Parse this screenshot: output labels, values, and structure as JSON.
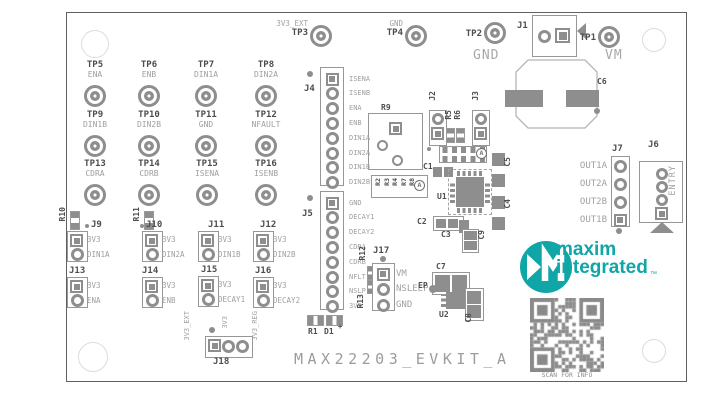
{
  "board": {
    "title": "MAX22203_EVKIT_A",
    "scan_label": "SCAN FOR INFO"
  },
  "logo": {
    "line1": "maxim",
    "line2": "integrated",
    "tm": "™"
  },
  "marker": "A",
  "colors": {
    "teal": "#10a5a6",
    "silk_dark": "#4d4d4d",
    "silk_light": "#a0a0a0",
    "pad": "#8e8e8e",
    "qr": "#8a8a8a"
  },
  "test_points": [
    {
      "ref": "TP5",
      "signal": "ENA",
      "x": 95,
      "y": 96
    },
    {
      "ref": "TP6",
      "signal": "ENB",
      "x": 149,
      "y": 96
    },
    {
      "ref": "TP7",
      "signal": "DIN1A",
      "x": 206,
      "y": 96
    },
    {
      "ref": "TP8",
      "signal": "DIN2A",
      "x": 266,
      "y": 96
    },
    {
      "ref": "TP9",
      "signal": "DIN1B",
      "x": 95,
      "y": 146
    },
    {
      "ref": "TP10",
      "signal": "DIN2B",
      "x": 149,
      "y": 146
    },
    {
      "ref": "TP11",
      "signal": "GND",
      "x": 206,
      "y": 146
    },
    {
      "ref": "TP12",
      "signal": "NFAULT",
      "x": 266,
      "y": 146
    },
    {
      "ref": "TP13",
      "signal": "CDRA",
      "x": 95,
      "y": 195
    },
    {
      "ref": "TP14",
      "signal": "CDRB",
      "x": 149,
      "y": 195
    },
    {
      "ref": "TP15",
      "signal": "ISENA",
      "x": 207,
      "y": 195
    },
    {
      "ref": "TP16",
      "signal": "ISENB",
      "x": 266,
      "y": 195
    }
  ],
  "top_test_points": [
    {
      "ref": "TP3",
      "signal": "3V3_EXT",
      "x": 321,
      "y": 36,
      "big": false
    },
    {
      "ref": "TP4",
      "signal": "GND",
      "x": 416,
      "y": 36,
      "big": false
    },
    {
      "ref": "TP2",
      "signal": "GND",
      "x": 495,
      "y": 33,
      "big": true
    },
    {
      "ref": "TP1",
      "signal": "VM",
      "x": 609,
      "y": 37,
      "big": true
    }
  ],
  "headers": [
    {
      "ref": "J4",
      "pins": [
        "ISENA",
        "ISENB",
        "ENA",
        "ENB",
        "DIN1A",
        "DIN2A",
        "DIN1B",
        "DIN2B"
      ],
      "box": [
        320,
        67,
        24,
        119
      ],
      "ref_pos": [
        304,
        84
      ],
      "pin_cx": 332,
      "pin_y0": 79,
      "pitch": 14.8,
      "square": "first",
      "label_side": "right",
      "label_x": 349,
      "font": 7,
      "dot": [
        307,
        71
      ]
    },
    {
      "ref": "J5",
      "pins": [
        "GND",
        "DECAY1",
        "DECAY2",
        "CDRA",
        "CDRB",
        "NFLT",
        "NSLP",
        "3V3"
      ],
      "box": [
        320,
        191,
        24,
        119
      ],
      "ref_pos": [
        302,
        209
      ],
      "pin_cx": 332,
      "pin_y0": 203,
      "pitch": 14.8,
      "square": "first",
      "label_side": "right",
      "label_x": 349,
      "font": 7,
      "dot": [
        307,
        195
      ]
    },
    {
      "ref": "J7",
      "pins": [
        "OUT1A",
        "OUT2A",
        "OUT2B",
        "OUT1B"
      ],
      "box": [
        611,
        156,
        19,
        71
      ],
      "ref_pos": [
        612,
        144
      ],
      "pin_cx": 620,
      "pin_y0": 166,
      "pitch": 18,
      "square": "last",
      "label_side": "left",
      "label_x": 607,
      "font": 9,
      "dot": [
        616,
        228
      ]
    },
    {
      "ref": "J17",
      "pins": [
        "VM",
        "NSLEEP",
        "GND"
      ],
      "box": [
        372,
        263,
        23,
        48
      ],
      "ref_pos": [
        373,
        246
      ],
      "pin_cx": 383,
      "pin_y0": 274,
      "pitch": 15.5,
      "square": "first",
      "label_side": "right",
      "label_x": 396,
      "font": 9,
      "dot": [
        380,
        256
      ]
    }
  ],
  "jumpers": [
    {
      "ref": "J9",
      "rx": 91,
      "top": "3V3",
      "bottom": "DIN1A",
      "x": 67,
      "y": 231
    },
    {
      "ref": "J10",
      "rx": 146,
      "top": "3V3",
      "bottom": "DIN2A",
      "x": 142,
      "y": 231
    },
    {
      "ref": "J11",
      "rx": 208,
      "top": "3V3",
      "bottom": "DIN1B",
      "x": 198,
      "y": 231
    },
    {
      "ref": "J12",
      "rx": 260,
      "top": "3V3",
      "bottom": "DIN2B",
      "x": 253,
      "y": 231
    },
    {
      "ref": "J13",
      "rx": 69,
      "top": "3V3",
      "bottom": "ENA",
      "x": 67,
      "y": 277
    },
    {
      "ref": "J14",
      "rx": 142,
      "top": "3V3",
      "bottom": "ENB",
      "x": 142,
      "y": 277
    },
    {
      "ref": "J15",
      "rx": 201,
      "top": "3V3",
      "bottom": "DECAY1",
      "x": 198,
      "y": 276
    },
    {
      "ref": "J16",
      "rx": 255,
      "top": "3V3",
      "bottom": "DECAY2",
      "x": 253,
      "y": 277
    }
  ],
  "j1": {
    "ref": "J1"
  },
  "j6": {
    "ref": "J6",
    "label": "ENTRY"
  },
  "j18": {
    "ref": "J18",
    "labels": [
      "3V3_EXT",
      "3V3",
      "3V3_REG"
    ]
  },
  "resistor_block": {
    "refs": [
      "R2",
      "R3",
      "R4",
      "R7",
      "R8"
    ]
  },
  "components": [
    {
      "ref": "R9",
      "x": 381,
      "y": 103
    },
    {
      "ref": "C1",
      "x": 423,
      "y": 162
    },
    {
      "ref": "U1",
      "x": 437,
      "y": 192
    },
    {
      "ref": "C2",
      "x": 417,
      "y": 217
    },
    {
      "ref": "C3",
      "x": 441,
      "y": 230
    },
    {
      "ref": "C5",
      "x": 503,
      "y": 157,
      "rot": 1
    },
    {
      "ref": "C4",
      "x": 503,
      "y": 199,
      "rot": 1
    },
    {
      "ref": "C9",
      "x": 477,
      "y": 230,
      "rot": 1
    },
    {
      "ref": "C6",
      "x": 597,
      "y": 77
    },
    {
      "ref": "C7",
      "x": 436,
      "y": 262
    },
    {
      "ref": "EP",
      "x": 418,
      "y": 281
    },
    {
      "ref": "U2",
      "x": 439,
      "y": 310
    },
    {
      "ref": "C8",
      "x": 464,
      "y": 313,
      "rot": 1
    },
    {
      "ref": "J2",
      "x": 428,
      "y": 91,
      "rot": 1
    },
    {
      "ref": "J3",
      "x": 471,
      "y": 91,
      "rot": 1
    },
    {
      "ref": "R5",
      "x": 444,
      "y": 110,
      "rot": 1
    },
    {
      "ref": "R6",
      "x": 453,
      "y": 110,
      "rot": 1
    },
    {
      "ref": "R10",
      "x": 58,
      "y": 207,
      "rot": 1
    },
    {
      "ref": "R11",
      "x": 132,
      "y": 207,
      "rot": 1
    },
    {
      "ref": "R12",
      "x": 358,
      "y": 246,
      "rot": 1
    },
    {
      "ref": "R13",
      "x": 356,
      "y": 294,
      "rot": 1
    },
    {
      "ref": "R1",
      "x": 308,
      "y": 327
    },
    {
      "ref": "D1",
      "x": 324,
      "y": 327
    },
    {
      "ref": "+",
      "x": 338,
      "y": 323,
      "size": 7
    }
  ]
}
